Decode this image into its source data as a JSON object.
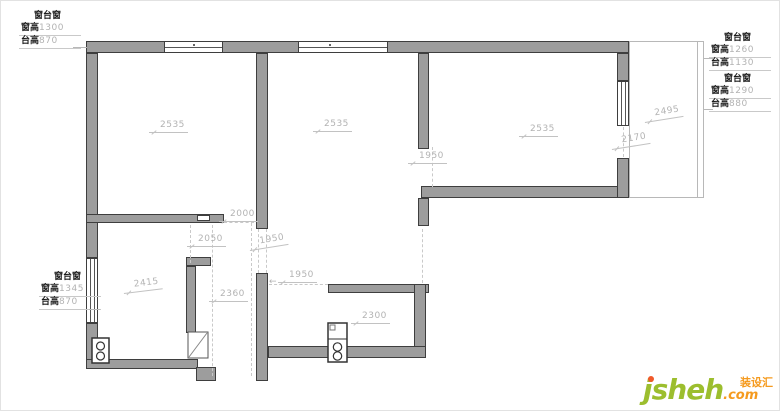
{
  "window_labels": {
    "top_left": {
      "title": "窗台窗",
      "win_label": "窗高",
      "win_value": "1300",
      "sill_label": "台高",
      "sill_value": "870"
    },
    "right_upper": {
      "title": "窗台窗",
      "win_label": "窗高",
      "win_value": "1260",
      "sill_label": "台高",
      "sill_value": "1130"
    },
    "right_lower": {
      "title": "窗台窗",
      "win_label": "窗高",
      "win_value": "1290",
      "sill_label": "台高",
      "sill_value": "880"
    },
    "bottom_left": {
      "title": "窗台窗",
      "win_label": "窗高",
      "win_value": "1345",
      "sill_label": "台高",
      "sill_value": "870"
    }
  },
  "dims": {
    "room1": "2535",
    "room2": "2535",
    "room3": "2535",
    "mid_opening": "1950",
    "balcony_depth": "2495",
    "balcony_opening": "2170",
    "hall_door": "2000",
    "closet": "2050",
    "hall_slant": "1950",
    "kitchen_opening": "1950",
    "arrow": "←",
    "room4": "2415",
    "hall_width": "2360",
    "kitchen": "2300"
  },
  "watermark": {
    "brand": "jsheh",
    "suffix": ".com",
    "badge": "装设汇"
  },
  "colors": {
    "wall_fill": "#9d9d9d",
    "wall_stroke": "#3e3e3e",
    "dim_text": "#b3b3b3",
    "brand_green": "#9cbe2e",
    "brand_orange": "#f59a1e"
  }
}
